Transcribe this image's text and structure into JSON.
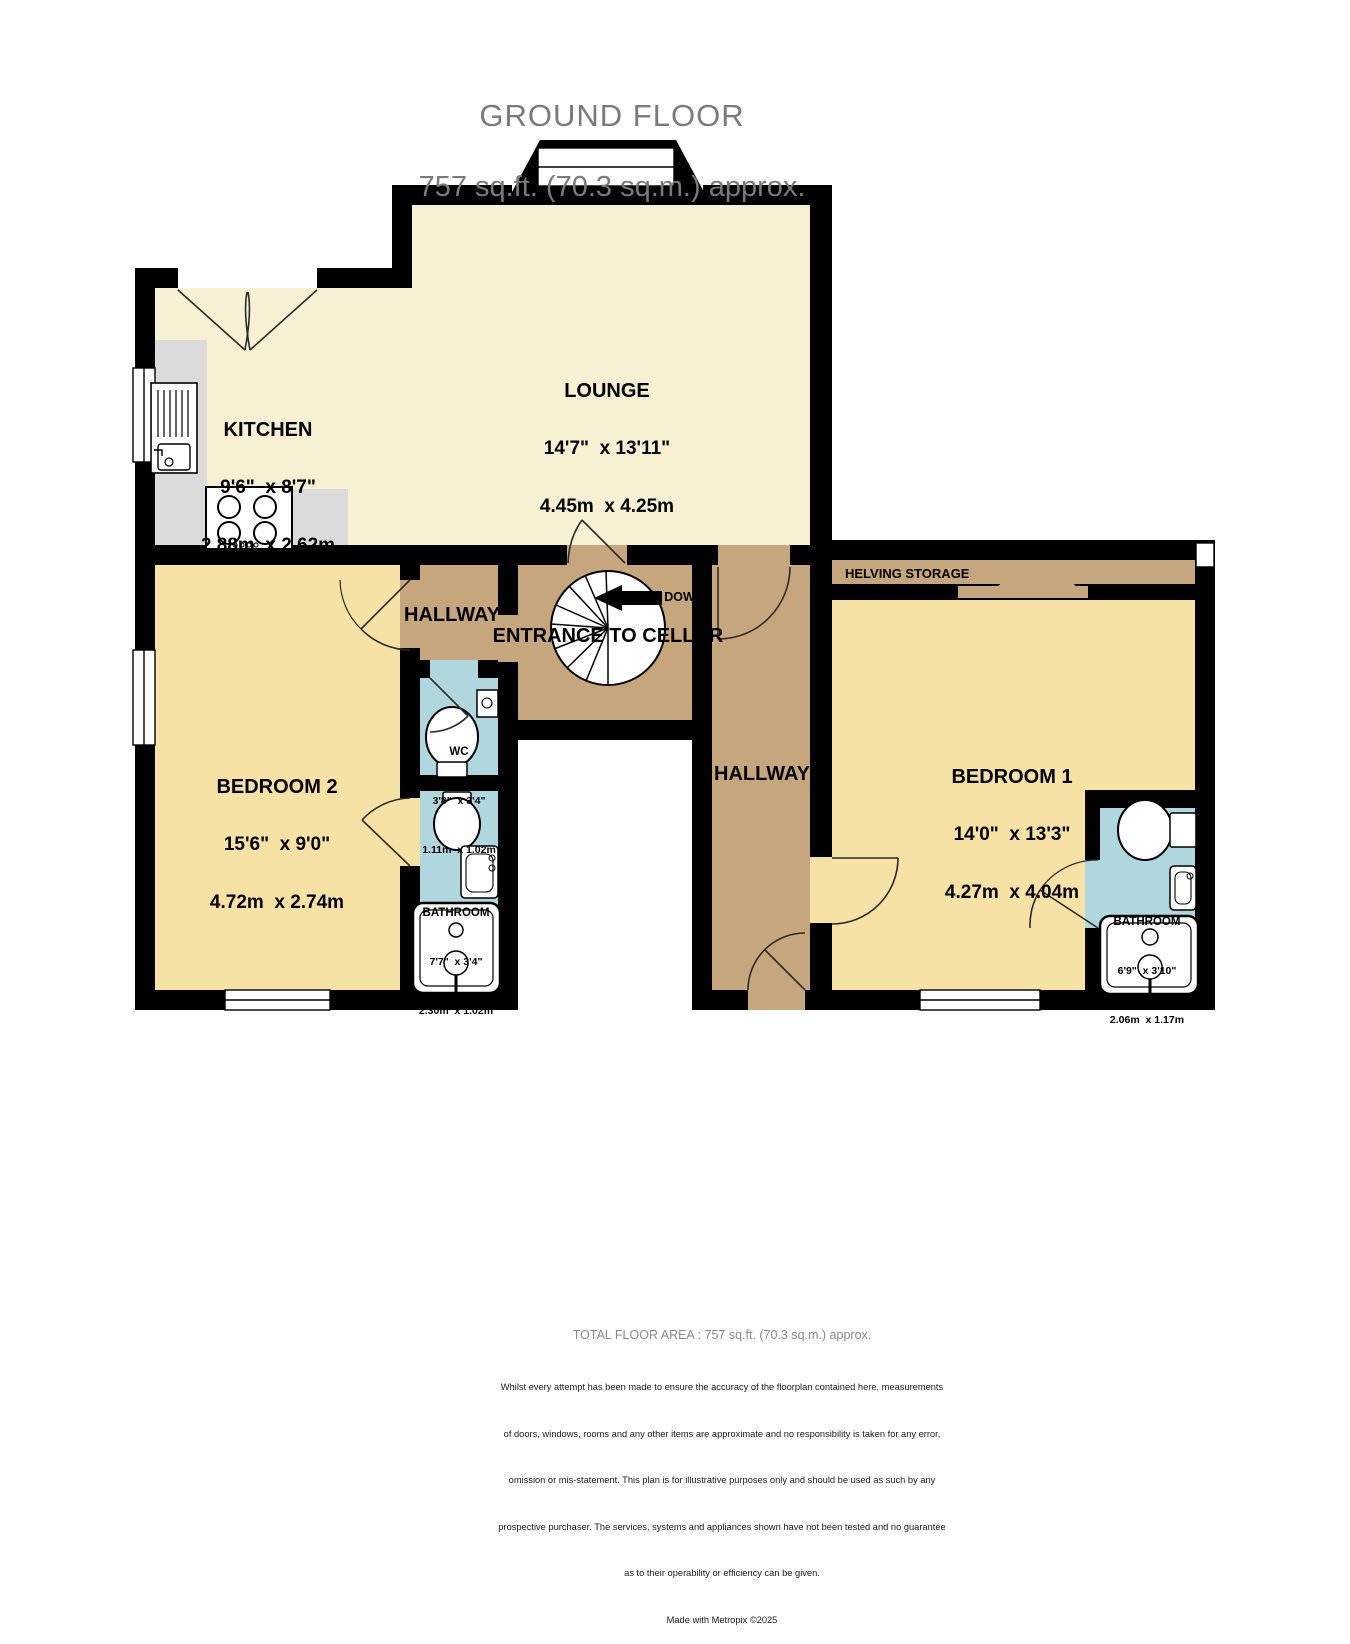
{
  "header": {
    "title": "GROUND FLOOR",
    "subtitle": "757 sq.ft. (70.3 sq.m.) approx."
  },
  "rooms": {
    "lounge": {
      "name": "LOUNGE",
      "imperial": "14'7\"  x 13'11\"",
      "metric": "4.45m  x 4.25m"
    },
    "kitchen": {
      "name": "KITCHEN",
      "imperial": "9'6\"  x 8'7\"",
      "metric": "2.88m  x 2.62m"
    },
    "bedroom2": {
      "name": "BEDROOM 2",
      "imperial": "15'6\"  x 9'0\"",
      "metric": "4.72m  x 2.74m"
    },
    "bedroom1": {
      "name": "BEDROOM 1",
      "imperial": "14'0\"  x 13'3\"",
      "metric": "4.27m  x 4.04m"
    },
    "wc": {
      "name": "WC",
      "imperial": "3'8\"  x 3'4\"",
      "metric": "1.11m  x 1.02m"
    },
    "bathroom_left": {
      "name": "BATHROOM",
      "imperial": "7'7\"  x 3'4\"",
      "metric": "2.30m  x 1.02m"
    },
    "bathroom_right": {
      "name": "BATHROOM",
      "imperial": "6'9\"  x 3'10\"",
      "metric": "2.06m  x 1.17m"
    }
  },
  "labels": {
    "hallway": "HALLWAY",
    "entrance_cellar": "ENTRANCE TO CELLAR",
    "down": "DOWN",
    "storage": "HELVING STORAGE"
  },
  "footer": {
    "total": "TOTAL FLOOR AREA : 757 sq.ft. (70.3 sq.m.) approx.",
    "disclaimer": [
      "Whilst every attempt has been made to ensure the accuracy of the floorplan contained here, measurements",
      "of doors, windows, rooms and any other items are approximate and no responsibility is taken for any error,",
      "omission or mis-statement. This plan is for illustrative purposes only and should be used as such by any",
      "prospective purchaser. The services, systems and appliances shown have not been tested and no guarantee",
      "as to their operability or efficiency can be given."
    ],
    "credit": "Made with Metropix ©2025"
  },
  "colors": {
    "floor-cream": "#F7F0D3",
    "floor-gold": "#F6E2A4",
    "floor-tan": "#C6A77D",
    "floor-blue": "#B0D7DD",
    "counter-gray": "#DBDBDB",
    "wall-black": "#000000",
    "title-gray": "#7a7a7a"
  }
}
